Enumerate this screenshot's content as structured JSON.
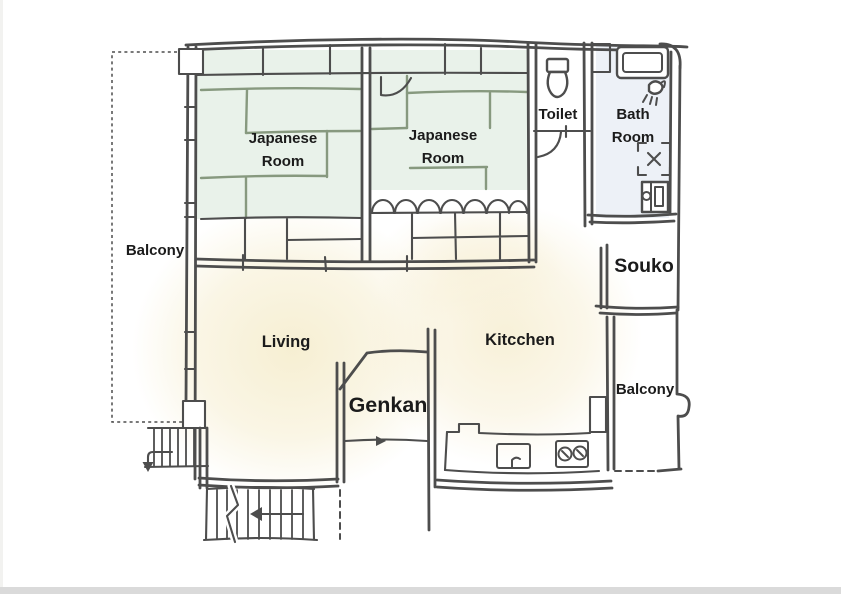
{
  "title": "apartment-floor-plan",
  "palette": {
    "paper": "#ffffff",
    "page_edge": "#dadada",
    "wall": "#4d4d4d",
    "tatami_fill": "#e9f2ea",
    "tatami_line": "#87997f",
    "bath_fill": "#edf1f7",
    "floor_cream": "#f6eed0",
    "text": "#1b1b1b"
  },
  "rooms": {
    "balcony_left": {
      "label": "Balcony"
    },
    "japanese_room_1": {
      "label_line1": "Japanese",
      "label_line2": "Room"
    },
    "japanese_room_2": {
      "label_line1": "Japanese",
      "label_line2": "Room"
    },
    "toilet": {
      "label": "Toilet"
    },
    "bath_room": {
      "label_line1": "Bath",
      "label_line2": "Room"
    },
    "souko": {
      "label": "Souko"
    },
    "balcony_right": {
      "label": "Balcony"
    },
    "living": {
      "label": "Living"
    },
    "kitchen": {
      "label": "Kitcchen"
    },
    "genkan": {
      "label": "Genkan"
    }
  },
  "icons": [
    "toilet-icon",
    "bathtub-icon",
    "shower-icon",
    "bath-mat-icon",
    "washing-machine-icon",
    "sink-icon",
    "stove-icon",
    "stairs-icon",
    "stairs-landing-icon",
    "down-arrow-icon",
    "left-arrow-icon",
    "entry-arrow-icon"
  ]
}
